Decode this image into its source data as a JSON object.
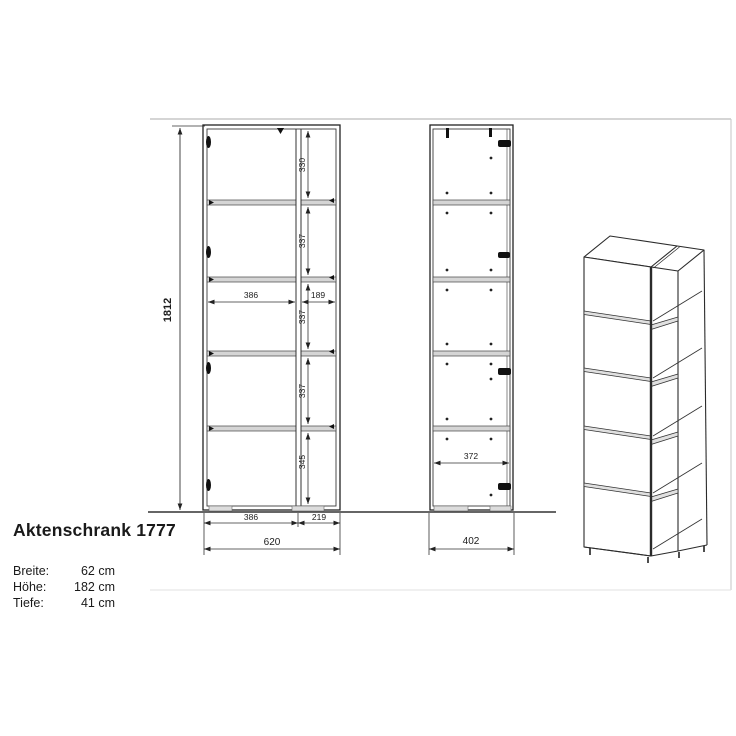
{
  "product": {
    "title": "Aktenschrank 1777",
    "specs": [
      {
        "label": "Breite:",
        "value": "62 cm"
      },
      {
        "label": "Höhe:",
        "value": "182 cm"
      },
      {
        "label": "Tiefe:",
        "value": "41 cm"
      }
    ]
  },
  "front_view": {
    "total_height_mm": "1812",
    "compartment_heights_mm": [
      "330",
      "337",
      "337",
      "337",
      "345"
    ],
    "inner_widths_mm": [
      "386",
      "189"
    ],
    "bottom_widths_mm": [
      "386",
      "219"
    ],
    "total_width_mm": "620"
  },
  "side_view": {
    "inner_depth_mm": "372",
    "total_depth_mm": "402"
  }
}
